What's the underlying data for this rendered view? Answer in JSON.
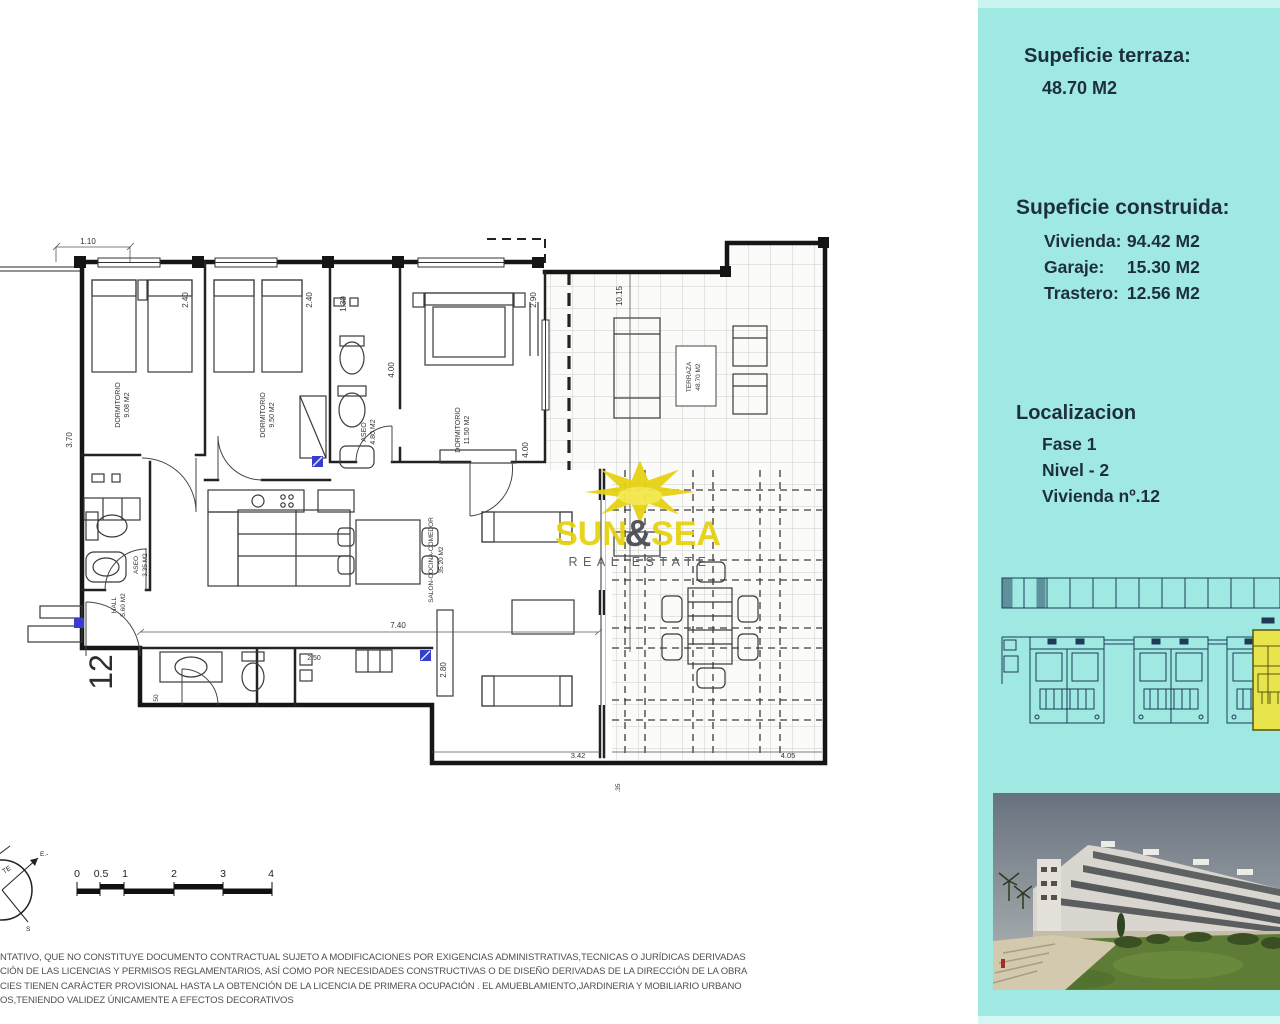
{
  "sidebar": {
    "bg_color": "#9fe9e2",
    "text_color": "#1e2e3e",
    "terraza_heading": "Supeficie terraza:",
    "terraza_value": "48.70 M2",
    "construida_heading": "Supeficie construida:",
    "construida_rows": [
      {
        "label": "Vivienda:",
        "value": "94.42 M2"
      },
      {
        "label": "Garaje:",
        "value": "15.30 M2"
      },
      {
        "label": "Trastero:",
        "value": "12.56 M2"
      }
    ],
    "localizacion_heading": "Localizacion",
    "localizacion_rows": [
      {
        "text": "Fase 1"
      },
      {
        "text": "Nivel - 2"
      },
      {
        "text": "Vivienda nº.12"
      }
    ],
    "siteplan": {
      "highlight_color": "#e7e44c",
      "line_color": "#1d3b57"
    }
  },
  "logo": {
    "word_sun": "SUN",
    "ampersand": "&",
    "word_sea": "SEA",
    "subtitle": "REAL ESTATE",
    "yellow": "#e6d214",
    "amp_color": "#4d4d57",
    "subtitle_color": "#565861"
  },
  "plan": {
    "unit_number": "12",
    "marker_color": "#3b3bd0",
    "rooms": {
      "dorm1": {
        "name": "DORMITORIO",
        "area": "9.08 M2"
      },
      "dorm2": {
        "name": "DORMITORIO",
        "area": "9.50 M2"
      },
      "aseo1": {
        "name": "ASEO",
        "area": "4.80 M2"
      },
      "dorm3": {
        "name": "DORMITORIO",
        "area": "11.50 M2"
      },
      "terraza": {
        "name": "TERRAZA",
        "area": "48.70 M2"
      },
      "salon": {
        "name": "SALON-COCINA-COMEDOR",
        "area": "35.20 M2"
      },
      "aseo2": {
        "name": "ASEO",
        "area": "3.35 M2"
      },
      "hall": {
        "name": "HALL",
        "area": "5.60 M2"
      }
    },
    "dims": {
      "d110": "1.10",
      "d370": "3.70",
      "d240a": "2.40",
      "d240b": "2.40",
      "d130": "1.30",
      "d400a": "4.00",
      "d290": "2.90",
      "d1015": "10.15",
      "d400b": "4.00",
      "d740": "7.40",
      "d250": "2.50",
      "d280": "2.80",
      "d342": "3.42",
      "d405": "4.05",
      "d035": ".35",
      "d50": "50"
    }
  },
  "scalebar": {
    "labels": [
      "0",
      "0.5",
      "1",
      "2",
      "3",
      "4"
    ]
  },
  "compass": {
    "label_te": "TE",
    "label_e": "E.-",
    "label_s": "S"
  },
  "disclaimer": {
    "lines": [
      "NTATIVO, QUE NO CONSTITUYE DOCUMENTO CONTRACTUAL SUJETO A MODIFICACIONES POR EXIGENCIAS ADMINISTRATIVAS,TECNICAS O JURÍDICAS DERIVADAS",
      "CIÓN DE LAS LICENCIAS Y PERMISOS REGLAMENTARIOS, ASÍ COMO POR NECESIDADES CONSTRUCTIVAS  O DE DISEÑO DERIVADAS DE LA DIRECCIÓN DE LA OBRA",
      "CIES TIENEN CARÁCTER PROVISIONAL HASTA LA OBTENCIÓN DE LA LICENCIA DE PRIMERA OCUPACIÓN . EL AMUEBLAMIENTO,JARDINERIA Y MOBILIARIO URBANO",
      "OS,TENIENDO VALIDEZ ÚNICAMENTE  A EFECTOS DECORATIVOS"
    ]
  }
}
